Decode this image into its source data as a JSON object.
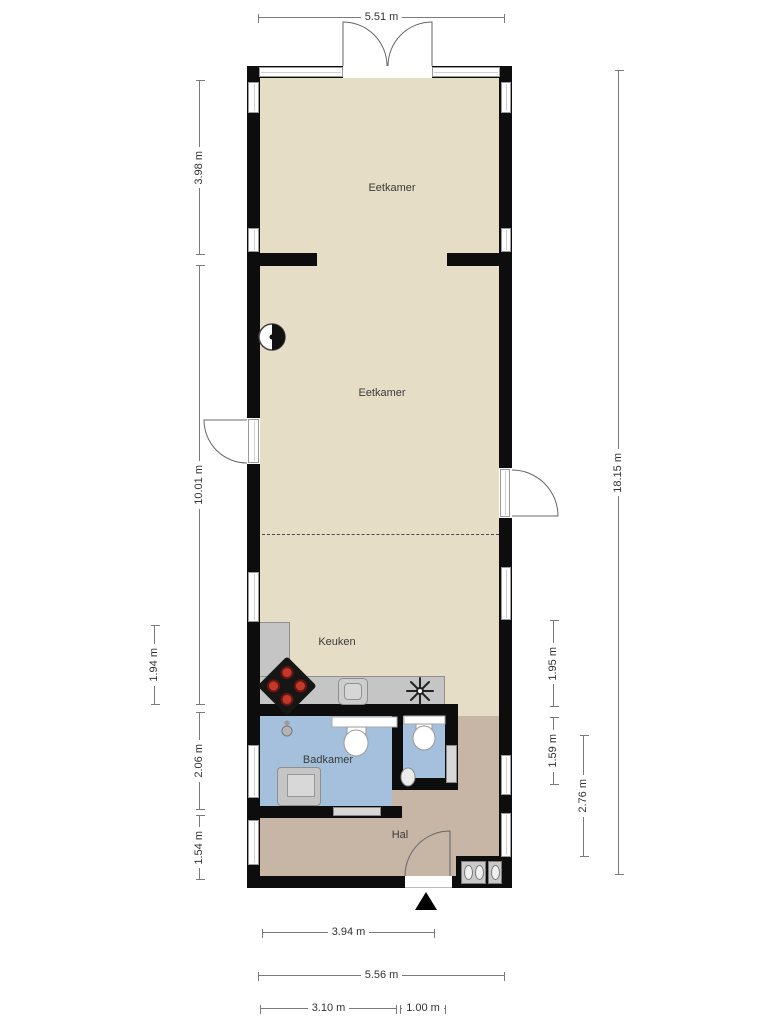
{
  "plan": {
    "type": "floor-plan",
    "language": "nl"
  },
  "rooms": {
    "dining_top": "Eetkamer",
    "dining_main": "Eetkamer",
    "kitchen": "Keuken",
    "bathroom": "Badkamer",
    "hall": "Hal"
  },
  "dimensions": {
    "top_width": "5.51 m",
    "left_upper": "3.98 m",
    "left_main": "10.01 m",
    "left_kitchen": "1.94 m",
    "left_bathroom": "2.06 m",
    "left_hall": "1.54 m",
    "right_kitchen": "1.95 m",
    "right_wc": "1.59 m",
    "right_hall": "2.76 m",
    "right_total": "18.15 m",
    "bottom_hall": "3.94 m",
    "bottom_width": "5.56 m",
    "bottom_bathroom": "3.10 m",
    "bottom_wc": "1.00 m"
  },
  "icons": {
    "north_arrow": "solid black up-triangle",
    "wood_stove": "half-filled circle on wall",
    "cooktop": "rotated black square with 4 red burners",
    "kitchen_sink": "rounded square basin",
    "ventilation": "asterisk fan symbol",
    "toilet": "oval bowl with cistern",
    "washbasin": "oval basin",
    "shower_head": "small grey circle",
    "appliances": "washer and dryer in niche"
  },
  "colors": {
    "wall": "#0d0d0d",
    "floor": "#e5ddc5",
    "bathroom_floor": "#a4c0dd",
    "hall_floor": "#c7b5a5",
    "counter": "#c5c5c5",
    "burner": "#c0392b",
    "dimension_line": "#7a7a7a",
    "text": "#333333"
  }
}
